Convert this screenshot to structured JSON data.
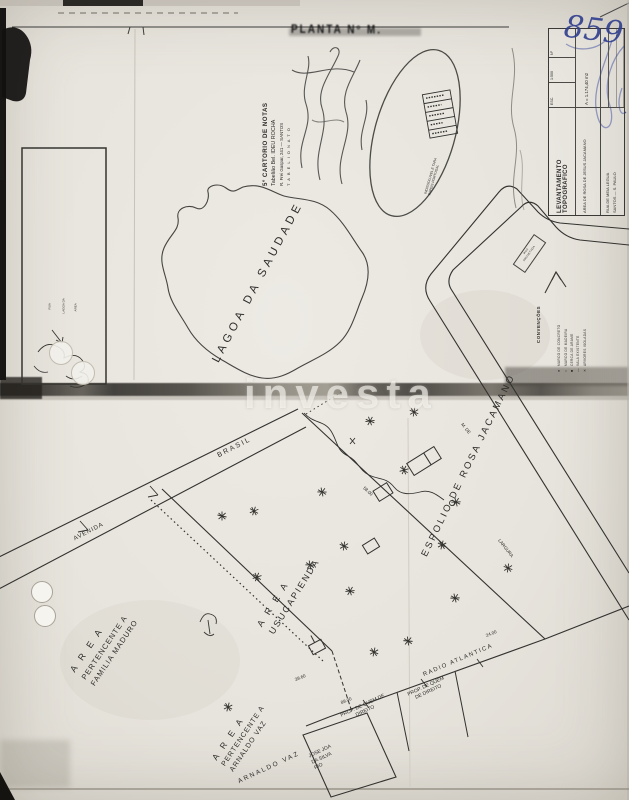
{
  "page": {
    "watermark": "investa",
    "handwritten_number": "859",
    "smudge_stamp": "PLANTA Nº M."
  },
  "notary_stamp": {
    "line1": "5º CARTORIO DE NOTAS",
    "line2": "Tabelião Bel. IDEU ROCHA",
    "line3": "R. Frei Gaspar, 241 — SANTOS",
    "line4": "T A B E L I O N A T O"
  },
  "seal": {
    "line1": "INDISSOLUVEL E TARA",
    "line2": "PAPEIS PORTUGAL"
  },
  "title_block": {
    "title": "LEVANTAMENTO   TOPOGRAFICO",
    "cell_esc": "ESC.",
    "cell_escala": "1:500",
    "cell_no": "Nº",
    "area_line": "AREA DE ROSA DE JESUS JACAMANO",
    "area_value": "A = 1.174,40 m2",
    "loc_line1": "RUA DE MEIA LEGUA",
    "loc_line2": "SANTOS — S. PAULO"
  },
  "legend": {
    "title": "CONVENÇÕES",
    "items": [
      {
        "symbol": "●",
        "text": "MARCO DE CONCRETO"
      },
      {
        "symbol": "○",
        "text": "MARCO DE MADEIRA"
      },
      {
        "symbol": "■",
        "text": "CERCA DE ARAME"
      },
      {
        "symbol": "—",
        "text": "VALA EXISTENTE"
      },
      {
        "symbol": "✕",
        "text": "ARVORES ISOLADAS"
      }
    ]
  },
  "cartouche": {
    "line1": "RUA",
    "line2": "PROJETADA"
  },
  "labels": {
    "lagoa": "LAGOA  DA  SAUDADE",
    "espolio": "ESPOLIO  DE  ROSA  JACAMANO",
    "area1": "A R E A",
    "area2": "USUCAPIENDA",
    "maduro1": "A R E A",
    "maduro2": "PERTENCENTE  A",
    "maduro3": "FAMILIA  MADURO",
    "arnaldo1": "A R E A",
    "arnaldo2": "PERTENCENTE  A",
    "arnaldo3": "ARNALDO  VAZ",
    "brasil": "BRASIL",
    "avenida": "AVENIDA",
    "radio": "RADIO  ATLANTICA",
    "prop_a1": "PROP. DE QUEM DE",
    "prop_a2": "DIREITO",
    "prop_b1": "PROP. DE QUEM",
    "prop_b2": "DE DIREITO",
    "jose1": "JOSE JOA",
    "jose2": "DA SILVA",
    "jose3": "RIO",
    "arnaldo_vaz": "ARNALDO  VAZ",
    "largura": "LARGURA",
    "m_de": "M. DE",
    "dim1": "89.00",
    "dim2": "39.60",
    "dim3": "24.00",
    "dim4": "58.00"
  },
  "situacao": {
    "label1": "RUA",
    "label2": "LAGOA DA",
    "label3": "AREA"
  }
}
